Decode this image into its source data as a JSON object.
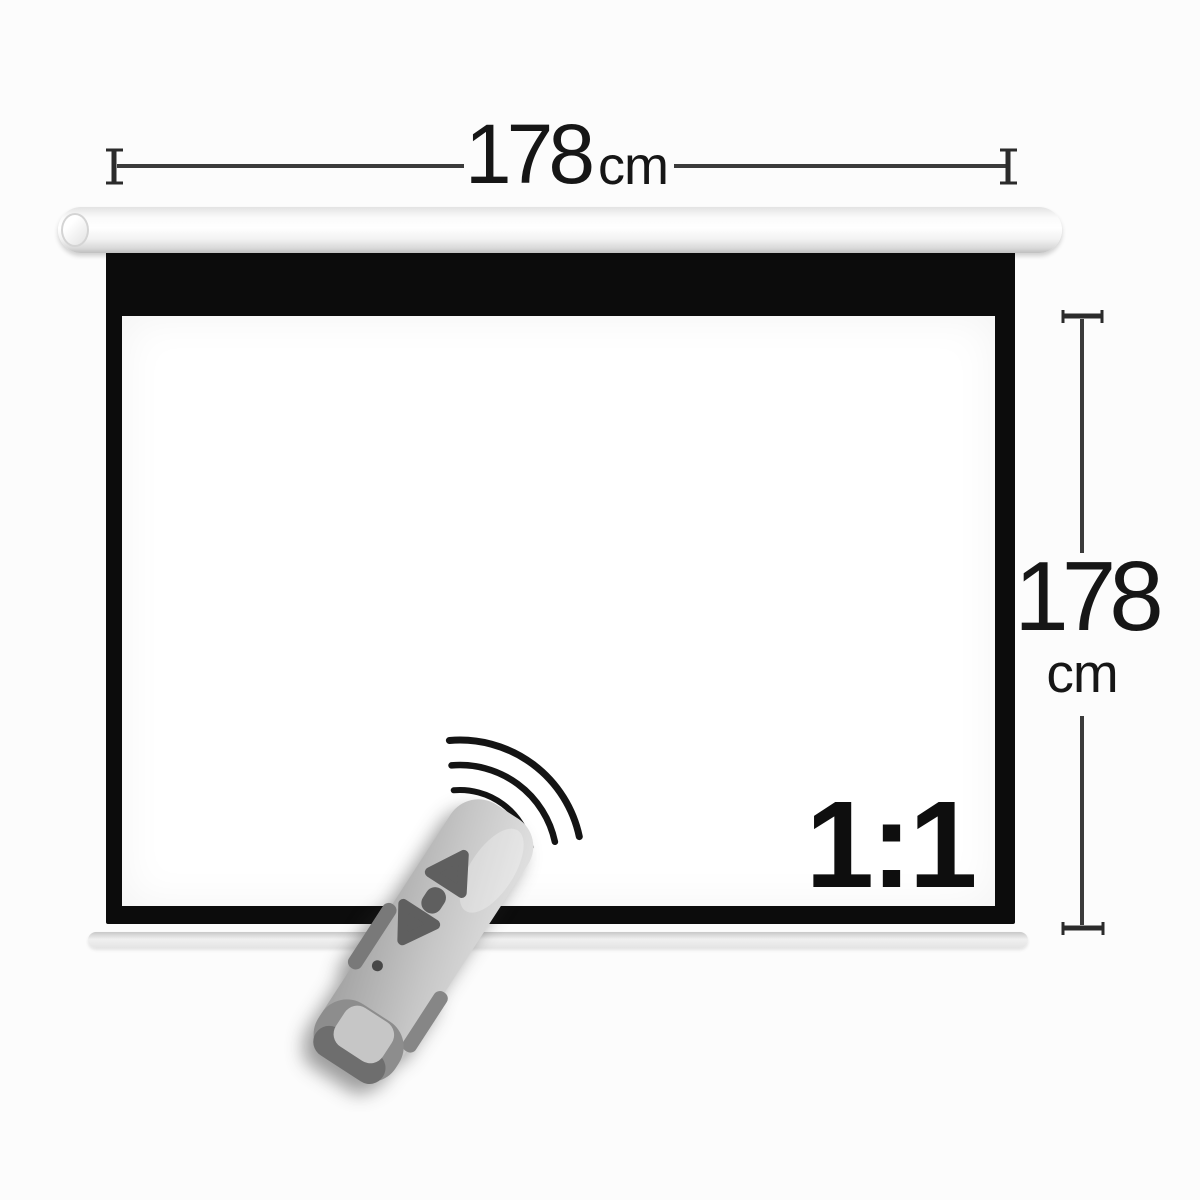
{
  "labels": {
    "width_dimension": {
      "value": "178",
      "unit": "cm"
    },
    "height_dimension": {
      "value": "178",
      "unit": "cm"
    },
    "aspect_ratio": "1:1"
  },
  "icons": {
    "signal_waves": "wireless-signal-arcs",
    "remote_up_button": "triangle-up",
    "remote_stop_button": "pill",
    "remote_down_button": "triangle-down",
    "remote_led": "indicator-dot",
    "dimension_end_ticks": "i-beam-tick"
  },
  "colors": {
    "background": "#fcfcfc",
    "frame_border": "#0c0c0c",
    "screen_surface": "#ffffff",
    "housing": "#f4f4f4",
    "bottom_slat": "#e8e8e8",
    "dimension_lines": "#333333",
    "label_text": "#161616",
    "remote_body": "#c4c4c4",
    "remote_buttons": "#5f5f5f",
    "signal_arcs": "#141414"
  }
}
